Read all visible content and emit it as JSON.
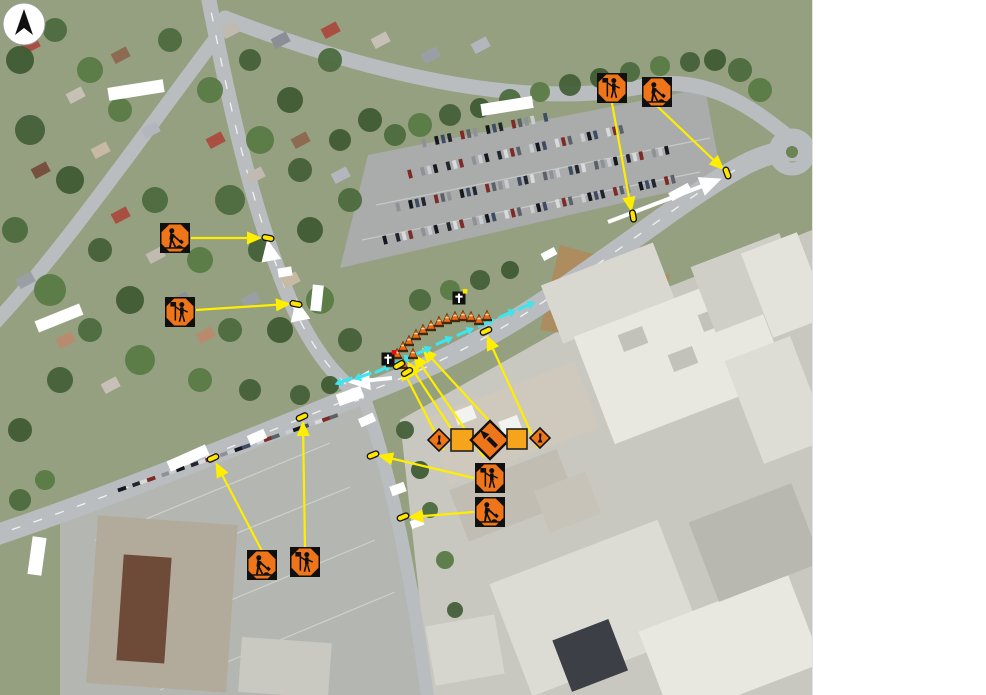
{
  "map": {
    "width": 812,
    "height": 695,
    "kind": "aerial-photo-traffic-control-plan"
  },
  "side_panel": {
    "background": "#ffffff"
  },
  "colors": {
    "sign_orange": "#ee7519",
    "sign_square_orange": "#f7a41d",
    "leader_yellow": "#ffee00",
    "marker_yellow": "#ffe400",
    "lane_arrow_cyan": "#3ee4ee",
    "cone_orange": "#f06a12",
    "road_arrow_white": "#ffffff",
    "sign_black": "#101010"
  },
  "north_arrow": {
    "icon": "north-arrow-icon",
    "cx": 23,
    "cy": 23,
    "r": 21
  },
  "traffic_signs": [
    {
      "icon": "flagger-ahead-sign-icon",
      "type": "flagger",
      "x": 612,
      "y": 88,
      "size": 30
    },
    {
      "icon": "roadwork-sign-icon",
      "type": "worker",
      "x": 657,
      "y": 92,
      "size": 30
    },
    {
      "icon": "roadwork-sign-icon",
      "type": "worker",
      "x": 175,
      "y": 238,
      "size": 30
    },
    {
      "icon": "flagger-ahead-sign-icon",
      "type": "flagger",
      "x": 180,
      "y": 312,
      "size": 30
    },
    {
      "icon": "flagger-ahead-sign-icon",
      "type": "flagger",
      "x": 490,
      "y": 478,
      "size": 30
    },
    {
      "icon": "roadwork-sign-icon",
      "type": "worker",
      "x": 490,
      "y": 512,
      "size": 30
    },
    {
      "icon": "roadwork-sign-icon",
      "type": "worker",
      "x": 262,
      "y": 565,
      "size": 30
    },
    {
      "icon": "flagger-ahead-sign-icon",
      "type": "flagger",
      "x": 305,
      "y": 562,
      "size": 30
    },
    {
      "icon": "worker-diamond-sign-icon",
      "type": "diamond-small",
      "x": 439,
      "y": 440,
      "size": 22
    },
    {
      "icon": "blank-square-sign-icon",
      "type": "square-blank",
      "x": 462,
      "y": 440,
      "size": 22
    },
    {
      "icon": "lane-shift-left-arrow-sign-icon",
      "type": "diamond-arrow-left",
      "x": 490,
      "y": 440,
      "size": 38
    },
    {
      "icon": "blank-square-sign-icon",
      "type": "square-blank",
      "x": 517,
      "y": 439,
      "size": 20
    },
    {
      "icon": "worker-diamond-sign-icon",
      "type": "diamond-small",
      "x": 540,
      "y": 438,
      "size": 20
    }
  ],
  "existing_sign_symbols": [
    {
      "icon": "sign-post-symbol-icon",
      "x": 388,
      "y": 359,
      "dot": "#e01010"
    },
    {
      "icon": "sign-post-symbol-icon",
      "x": 459,
      "y": 298,
      "dot": "#ffe400"
    }
  ],
  "location_markers": [
    {
      "x": 633,
      "y": 216,
      "rot": 80
    },
    {
      "x": 727,
      "y": 173,
      "rot": 70
    },
    {
      "x": 268,
      "y": 238,
      "rot": 12
    },
    {
      "x": 296,
      "y": 304,
      "rot": 12
    },
    {
      "x": 213,
      "y": 458,
      "rot": -25
    },
    {
      "x": 302,
      "y": 417,
      "rot": -25
    },
    {
      "x": 373,
      "y": 455,
      "rot": -22
    },
    {
      "x": 403,
      "y": 517,
      "rot": -22
    },
    {
      "x": 486,
      "y": 331,
      "rot": -25
    },
    {
      "x": 399,
      "y": 365,
      "rot": -30
    },
    {
      "x": 407,
      "y": 372,
      "rot": -30
    }
  ],
  "leader_lines": [
    {
      "x1": 612,
      "y1": 103,
      "x2": 631,
      "y2": 209
    },
    {
      "x1": 657,
      "y1": 106,
      "x2": 722,
      "y2": 168
    },
    {
      "x1": 191,
      "y1": 238,
      "x2": 259,
      "y2": 238
    },
    {
      "x1": 196,
      "y1": 310,
      "x2": 288,
      "y2": 304
    },
    {
      "x1": 262,
      "y1": 551,
      "x2": 217,
      "y2": 465
    },
    {
      "x1": 305,
      "y1": 548,
      "x2": 303,
      "y2": 424
    },
    {
      "x1": 474,
      "y1": 478,
      "x2": 381,
      "y2": 456
    },
    {
      "x1": 474,
      "y1": 512,
      "x2": 411,
      "y2": 517
    },
    {
      "x1": 444,
      "y1": 450,
      "x2": 402,
      "y2": 368
    },
    {
      "x1": 465,
      "y1": 450,
      "x2": 409,
      "y2": 364
    },
    {
      "x1": 484,
      "y1": 457,
      "x2": 415,
      "y2": 356
    },
    {
      "x1": 514,
      "y1": 448,
      "x2": 424,
      "y2": 350
    },
    {
      "x1": 538,
      "y1": 448,
      "x2": 488,
      "y2": 338
    }
  ],
  "lane_arrows": [
    {
      "x": 344,
      "y": 381,
      "rot": 160
    },
    {
      "x": 363,
      "y": 376,
      "rot": 160
    },
    {
      "x": 383,
      "y": 369,
      "rot": -24
    },
    {
      "x": 403,
      "y": 360,
      "rot": -24
    },
    {
      "x": 423,
      "y": 351,
      "rot": -24
    },
    {
      "x": 444,
      "y": 341,
      "rot": -24
    },
    {
      "x": 465,
      "y": 332,
      "rot": -24
    },
    {
      "x": 486,
      "y": 323,
      "rot": -24
    },
    {
      "x": 507,
      "y": 314,
      "rot": -24
    },
    {
      "x": 526,
      "y": 306,
      "rot": -24
    }
  ],
  "cones": [
    {
      "x": 391,
      "y": 362
    },
    {
      "x": 397,
      "y": 354
    },
    {
      "x": 403,
      "y": 347
    },
    {
      "x": 409,
      "y": 341
    },
    {
      "x": 416,
      "y": 335
    },
    {
      "x": 423,
      "y": 330
    },
    {
      "x": 431,
      "y": 326
    },
    {
      "x": 439,
      "y": 322
    },
    {
      "x": 447,
      "y": 319
    },
    {
      "x": 455,
      "y": 317
    },
    {
      "x": 463,
      "y": 316
    },
    {
      "x": 471,
      "y": 317
    },
    {
      "x": 479,
      "y": 320
    },
    {
      "x": 487,
      "y": 316
    },
    {
      "x": 403,
      "y": 364
    },
    {
      "x": 413,
      "y": 354
    }
  ],
  "road_arrows": [
    {
      "x1": 392,
      "y1": 378,
      "x2": 352,
      "y2": 382
    },
    {
      "x1": 608,
      "y1": 222,
      "x2": 718,
      "y2": 180
    },
    {
      "x1": 271,
      "y1": 259,
      "x2": 268,
      "y2": 243
    },
    {
      "x1": 300,
      "y1": 318,
      "x2": 297,
      "y2": 303
    }
  ],
  "blank_labels": [
    {
      "x": 136,
      "y": 90,
      "w": 56,
      "h": 13,
      "rot": -9
    },
    {
      "x": 507,
      "y": 106,
      "w": 52,
      "h": 12,
      "rot": -9
    },
    {
      "x": 680,
      "y": 192,
      "w": 22,
      "h": 9,
      "rot": -28
    },
    {
      "x": 549,
      "y": 254,
      "w": 15,
      "h": 8,
      "rot": -28
    },
    {
      "x": 59,
      "y": 318,
      "w": 48,
      "h": 12,
      "rot": -22
    },
    {
      "x": 285,
      "y": 272,
      "w": 14,
      "h": 9,
      "rot": -10
    },
    {
      "x": 317,
      "y": 298,
      "w": 11,
      "h": 26,
      "rot": 6
    },
    {
      "x": 257,
      "y": 437,
      "w": 18,
      "h": 10,
      "rot": -24
    },
    {
      "x": 188,
      "y": 458,
      "w": 42,
      "h": 11,
      "rot": -24
    },
    {
      "x": 37,
      "y": 556,
      "w": 14,
      "h": 38,
      "rot": 8
    },
    {
      "x": 367,
      "y": 420,
      "w": 16,
      "h": 9,
      "rot": -24
    },
    {
      "x": 350,
      "y": 396,
      "w": 26,
      "h": 12,
      "rot": -20
    },
    {
      "x": 398,
      "y": 489,
      "w": 15,
      "h": 10,
      "rot": -20
    },
    {
      "x": 417,
      "y": 523,
      "w": 13,
      "h": 8,
      "rot": -20
    }
  ]
}
